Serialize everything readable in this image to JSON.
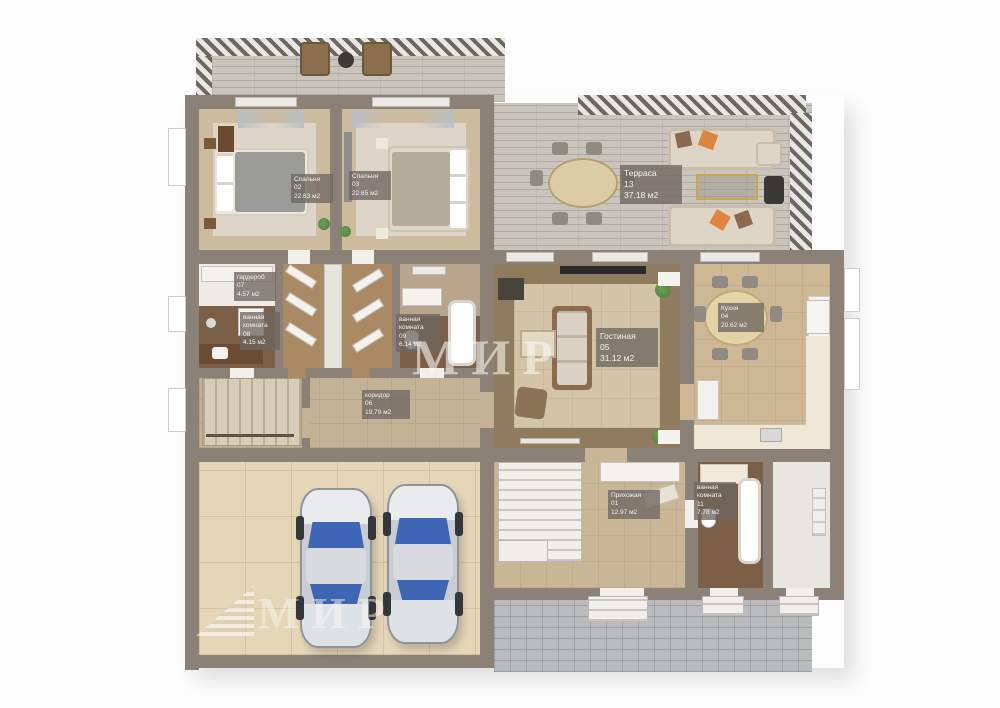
{
  "title": "3D floor plan",
  "watermark": {
    "text": "МИР"
  },
  "rooms": [
    {
      "name": "Спальня",
      "number": "02",
      "area": "22.63 м2"
    },
    {
      "name": "Спальня",
      "number": "03",
      "area": "22.65 м2"
    },
    {
      "name": "гардероб",
      "number": "07",
      "area": "4.57 м2"
    },
    {
      "name": "ванная комната",
      "number": "08",
      "area": "4.15 м2"
    },
    {
      "name": "ванная комната",
      "number": "09",
      "area": "6.14 м2"
    },
    {
      "name": "коридор",
      "number": "06",
      "area": "19.79 м2"
    },
    {
      "name": "Гостиная",
      "number": "05",
      "area": "31.12 м2"
    },
    {
      "name": "Терраса",
      "number": "13",
      "area": "37.18 м2"
    },
    {
      "name": "Кухня",
      "number": "04",
      "area": "20.62 м2"
    },
    {
      "name": "Прихожая",
      "number": "01",
      "area": "12.97 м2"
    },
    {
      "name": "ванная комната",
      "number": "11",
      "area": "7.78 м2"
    }
  ],
  "colors": {
    "wall": "#8b8177",
    "floor_light": "#ddd5c7",
    "floor_beige": "#cdbb9e",
    "floor_tan": "#c3b295",
    "floor_brown": "#7b5f47",
    "closet_wood": "#a98a64",
    "deck": "#c9c5bc",
    "patio": "#b9bbbd",
    "garage_floor": "#e5d6b7",
    "car_body": "#c9ccd1",
    "car_glass": "#3f66b5",
    "pillow_orange": "#dd8440",
    "plant_green": "#4e7d3c",
    "label_bg": "rgba(110,103,96,0.78)",
    "watermark": "rgba(248,246,242,0.6)"
  }
}
